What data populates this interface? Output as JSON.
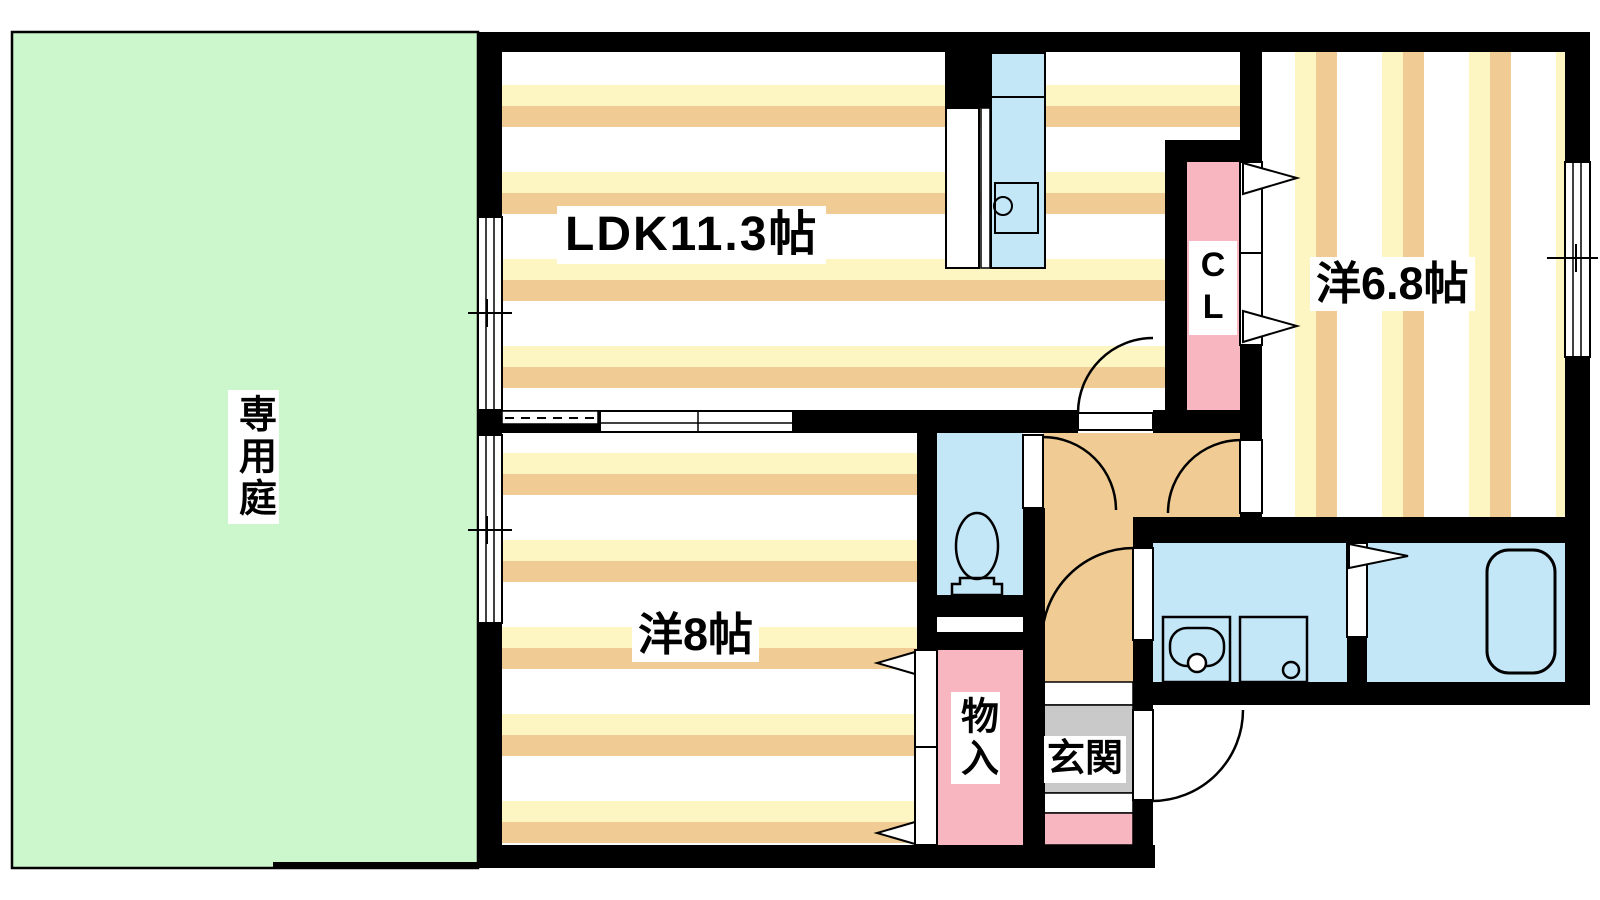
{
  "labels": {
    "garden": "専用庭",
    "ldk": "LDK11.3帖",
    "bedroom_right": "洋6.8帖",
    "bedroom_left": "洋8帖",
    "closet": "CL",
    "storage": "物入",
    "entrance": "玄関"
  },
  "colors": {
    "background": "#ffffff",
    "wall": "#000000",
    "garden_green": "#ccf6cb",
    "floor_white": "#ffffff",
    "stripe_yellow": "#fdf6c3",
    "stripe_tan": "#f0cb93",
    "hall_tan": "#f0cb93",
    "wet_area_blue": "#c4e7f8",
    "closet_pink": "#f8b6c0",
    "genkan_gray": "#c9c9c9",
    "door_white": "#ffffff",
    "label_text": "#000000"
  }
}
